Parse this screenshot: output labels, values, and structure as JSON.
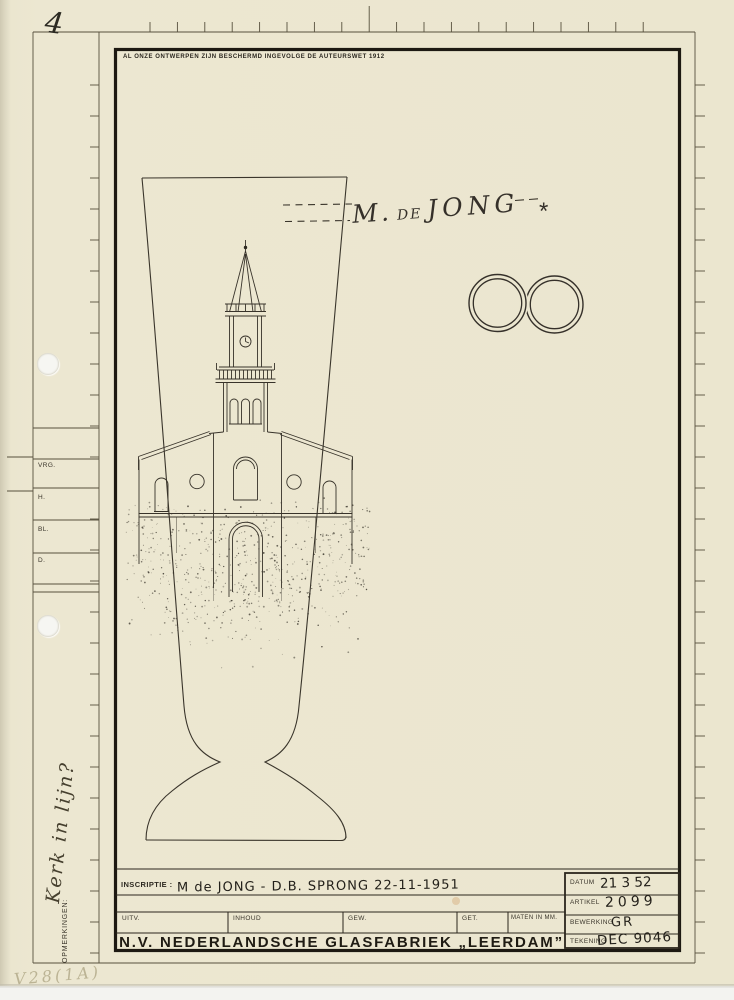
{
  "page": {
    "sheet_number": "4",
    "copyright_notice": "AL ONZE ONTWERPEN ZIJN BESCHERMD INGEVOLGE DE AUTEURSWET 1912",
    "pencil_note": "V28(1A)"
  },
  "margin_column": {
    "row_labels": [
      "VRG.",
      "H.",
      "BL.",
      "D."
    ],
    "remarks_label": "OPMERKINGEN:",
    "handwritten_note": "Kerk in lijn?"
  },
  "artwork": {
    "engraving_prefix": "M.",
    "engraving_de": "de",
    "engraving_name": "JONG",
    "engraving_mark": "*",
    "motifs": [
      "church-with-spire",
      "interlocked-wedding-rings",
      "goblet-outline"
    ]
  },
  "title_block": {
    "inscription_label": "INSCRIPTIE :",
    "inscription_value": "M de JONG - D.B. SPRONG   22-11-1951",
    "column_labels": [
      "UITV.",
      "INHOUD",
      "GEW.",
      "GET.",
      "MATEN IN MM."
    ],
    "company_name": "N.V. NEDERLANDSCHE GLASFABRIEK „LEERDAM”",
    "fields": [
      {
        "label": "DATUM",
        "value": "21  3  52"
      },
      {
        "label": "ARTIKEL",
        "value": "2099"
      },
      {
        "label": "BEWERKING",
        "value": "GR"
      },
      {
        "label": "TEKENING",
        "value": "DEC 9046"
      }
    ]
  },
  "colors": {
    "paper": "#ebe6cf",
    "ink": "#2b271f",
    "thin_line": "#4a4436",
    "pencil": "#b3ab8a",
    "rust_spot": "#c98f4f"
  }
}
